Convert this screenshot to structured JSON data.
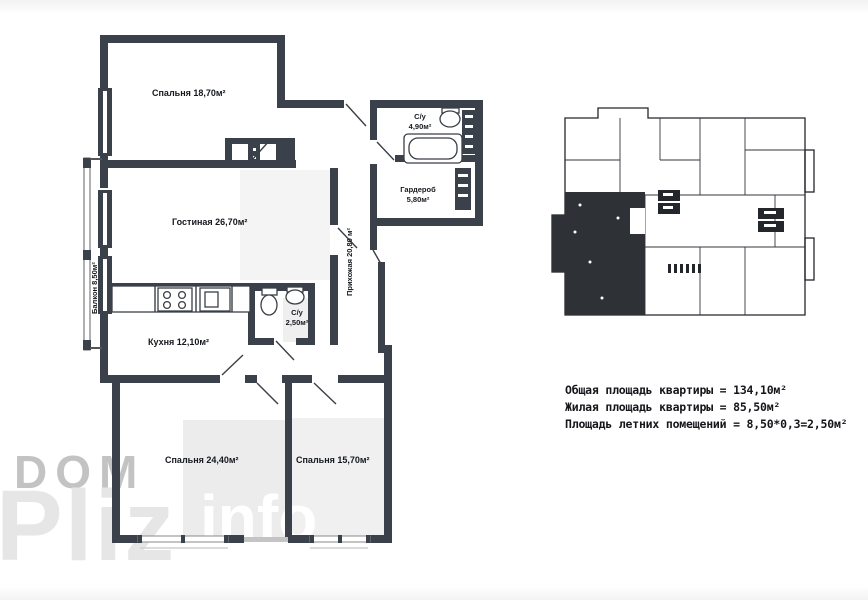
{
  "watermark": {
    "dom": "DOM",
    "pliz": "Pliz",
    "info": "info"
  },
  "plan": {
    "rooms": {
      "bedroom_top": "Спальня 18,70м²",
      "living": "Гостиная 26,70м²",
      "kitchen": "Кухня 12,10м²",
      "bath_main_name": "С/у",
      "bath_main_area": "4,90м²",
      "wardrobe_name": "Гардероб",
      "wardrobe_area": "5,80м²",
      "bath_small_name": "С/у",
      "bath_small_area": "2,50м²",
      "hallway": "Прихожая 20,80 м²",
      "balcony": "Балкон 8,50м²",
      "bedroom_left": "Спальня 24,40м²",
      "bedroom_right": "Спальня 15,70м²"
    }
  },
  "summary": {
    "total": "Общая площадь квартиры = 134,10м²",
    "living": "Жилая площадь квартиры = 85,50м²",
    "summer": "Площадь летних помещений = 8,50*0,3=2,50м²"
  },
  "colors": {
    "wall": "#3b414a",
    "highlighted_unit": "#2e3237",
    "watermark_gray": "#c3c3c3",
    "watermark_light": "#e6e6e6"
  }
}
